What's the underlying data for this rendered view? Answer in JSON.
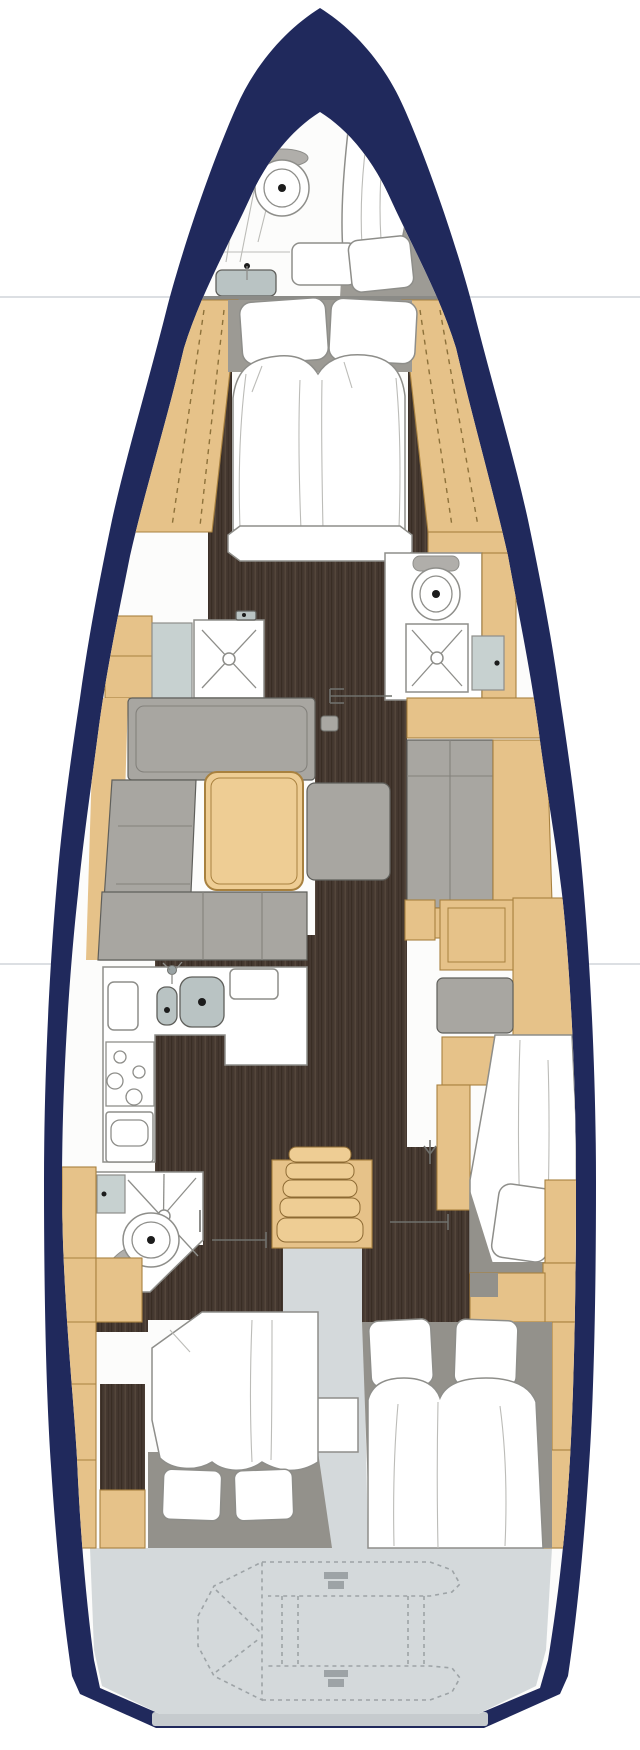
{
  "colors": {
    "bg": "#ffffff",
    "pageLine": "#dcdfe3",
    "hull": "#20295c",
    "interior": "#fcfcfb",
    "wood": "#e6c289",
    "woodBright": "#eecd94",
    "woodStroke": "#a8813f",
    "woodDash": "#8d713a",
    "floorDark": "#453830",
    "floorLineA": "#392d24",
    "floorLineB": "#54463b",
    "sofa": "#a8a6a1",
    "sofaLine": "#83817c",
    "headboard": "#9c9a94",
    "grayBase": "#93918b",
    "fixtureBlue": "#c7d1d0",
    "sinkGray": "#b9c3c3",
    "metalGray": "#9aa3a4",
    "transom": "#d4d9db",
    "transomEdge": "#c6cbce",
    "outline": "#8e8e8a",
    "outlineDark": "#5f5f5b",
    "white": "#ffffff",
    "foldLine": "#bcbcb8",
    "dinghy": "#9da3a6",
    "doorGray": "#6f706c",
    "dotDark": "#1c1c1c"
  }
}
